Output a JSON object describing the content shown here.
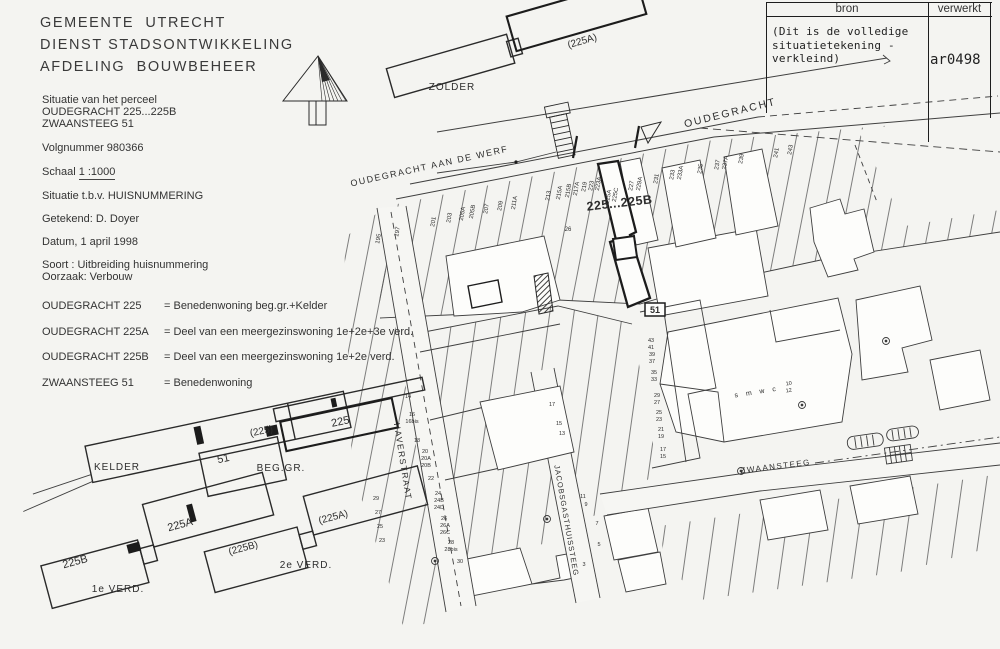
{
  "header": {
    "line1": "GEMEENTE  UTRECHT",
    "line2": "DIENST STADSONTWIKKELING",
    "line3": "AFDELING  BOUWBEHEER"
  },
  "info": {
    "situatie_label": "Situatie van het perceel",
    "address1": "OUDEGRACHT 225...225B",
    "address2": "ZWAANSTEEG 51",
    "volgnummer": "Volgnummer 980366",
    "schaal_label": "Schaal",
    "schaal_value": "1 :1000",
    "situatie_tbv": "Situatie t.b.v. HUISNUMMERING",
    "getekend": "Getekend: D. Doyer",
    "datum": "Datum, 1 april 1998",
    "soort": "Soort : Uitbreiding huisnummering",
    "oorzaak": "Oorzaak: Verbouw"
  },
  "legend": [
    {
      "address": "OUDEGRACHT 225",
      "desc": "= Benedenwoning beg.gr.+Kelder"
    },
    {
      "address": "OUDEGRACHT 225A",
      "desc": "= Deel van een meergezinswoning 1e+2e+3e verd."
    },
    {
      "address": "OUDEGRACHT 225B",
      "desc": "= Deel van een meergezinswoning 1e+2e verd."
    },
    {
      "address": "ZWAANSTEEG 51",
      "desc": "= Benedenwoning"
    }
  ],
  "stamp_table": {
    "col1": "bron",
    "col2": "verwerkt",
    "note": "(Dit is de volledige\nsituatietekening -\nverkleind)",
    "code": "ar0498"
  },
  "plans": {
    "labels": [
      {
        "t": "(225A)",
        "x": 583,
        "y": 44,
        "r": -16,
        "s": 10
      },
      {
        "t": "ZOLDER",
        "x": 452,
        "y": 90,
        "r": 0,
        "s": 10,
        "ls": 1
      },
      {
        "t": "(225)",
        "x": 262,
        "y": 434,
        "r": -12,
        "s": 10
      },
      {
        "t": "KELDER",
        "x": 117,
        "y": 470,
        "r": 0,
        "s": 10,
        "ls": 1
      },
      {
        "t": "51",
        "x": 224,
        "y": 462,
        "r": -12,
        "s": 11
      },
      {
        "t": "225",
        "x": 341,
        "y": 425,
        "r": -12,
        "s": 11
      },
      {
        "t": "BEG.GR.",
        "x": 281,
        "y": 471,
        "r": 0,
        "s": 10,
        "ls": 1
      },
      {
        "t": "225B",
        "x": 76,
        "y": 565,
        "r": -15,
        "s": 11
      },
      {
        "t": "225A",
        "x": 181,
        "y": 528,
        "r": -15,
        "s": 11
      },
      {
        "t": "1e VERD.",
        "x": 118,
        "y": 592,
        "r": 0,
        "s": 10,
        "ls": 1
      },
      {
        "t": "(225B)",
        "x": 244,
        "y": 551,
        "r": -15,
        "s": 10
      },
      {
        "t": "(225A)",
        "x": 334,
        "y": 520,
        "r": -15,
        "s": 10
      },
      {
        "t": "2e VERD.",
        "x": 306,
        "y": 568,
        "r": 0,
        "s": 10,
        "ls": 1
      }
    ]
  },
  "map": {
    "street_labels": [
      {
        "t": "OUDEGRACHT AAN DE WERF",
        "x": 430,
        "y": 169,
        "r": -12.5,
        "s": 9,
        "ls": 1.5
      },
      {
        "t": "OUDEGRACHT",
        "x": 731,
        "y": 116,
        "r": -14,
        "s": 10.5,
        "ls": 2
      },
      {
        "t": "HAVERSTRAAT",
        "x": 400,
        "y": 462,
        "r": 81,
        "s": 8.5,
        "ls": 1.5
      },
      {
        "t": "JACOBSGASTHUISSTEEG",
        "x": 564,
        "y": 521,
        "r": 80,
        "s": 7.5,
        "ls": 1
      },
      {
        "t": "ZWAANSTEEG",
        "x": 776,
        "y": 469,
        "r": -7,
        "s": 8,
        "ls": 1.5
      }
    ],
    "key_labels": [
      {
        "t": "225...225B",
        "x": 620,
        "y": 207,
        "r": -6.5,
        "s": 12.5,
        "w": 700,
        "ls": 0.5
      },
      {
        "t": "51",
        "x": 655,
        "y": 313,
        "r": 0,
        "s": 9,
        "w": 700
      },
      {
        "t": "s m w c",
        "x": 757,
        "y": 394,
        "r": -9,
        "s": 7,
        "ls": 3
      },
      {
        "t": "10",
        "x": 789,
        "y": 385,
        "r": -9,
        "s": 5.5
      },
      {
        "t": "12",
        "x": 789,
        "y": 392,
        "r": -9,
        "s": 5.5
      }
    ],
    "parcel_numbers": [
      {
        "t": "195",
        "x": 380,
        "y": 239,
        "r": -80,
        "s": 6
      },
      {
        "t": "197",
        "x": 399,
        "y": 232,
        "r": -80,
        "s": 6
      },
      {
        "t": "201",
        "x": 435,
        "y": 222,
        "r": -80,
        "s": 6
      },
      {
        "t": "203",
        "x": 451,
        "y": 218,
        "r": -80,
        "s": 6
      },
      {
        "t": "205A",
        "x": 464,
        "y": 214,
        "r": -80,
        "s": 6
      },
      {
        "t": "205B",
        "x": 474,
        "y": 212,
        "r": -80,
        "s": 6
      },
      {
        "t": "207",
        "x": 488,
        "y": 209,
        "r": -80,
        "s": 6
      },
      {
        "t": "209",
        "x": 502,
        "y": 206,
        "r": -80,
        "s": 6
      },
      {
        "t": "211A",
        "x": 516,
        "y": 203,
        "r": -80,
        "s": 6
      },
      {
        "t": "213",
        "x": 550,
        "y": 196,
        "r": -80,
        "s": 6
      },
      {
        "t": "215A",
        "x": 561,
        "y": 193,
        "r": -80,
        "s": 6
      },
      {
        "t": "215B",
        "x": 570,
        "y": 191,
        "r": -80,
        "s": 6
      },
      {
        "t": "217A",
        "x": 578,
        "y": 189,
        "r": -80,
        "s": 6
      },
      {
        "t": "219",
        "x": 586,
        "y": 187,
        "r": -80,
        "s": 6
      },
      {
        "t": "223",
        "x": 593,
        "y": 186,
        "r": -80,
        "s": 6
      },
      {
        "t": "223A",
        "x": 600,
        "y": 184,
        "r": -80,
        "s": 6
      },
      {
        "t": "225A",
        "x": 610,
        "y": 197,
        "r": -80,
        "s": 6
      },
      {
        "t": "225C",
        "x": 617,
        "y": 195,
        "r": -80,
        "s": 6
      },
      {
        "t": "227",
        "x": 633,
        "y": 186,
        "r": -80,
        "s": 6
      },
      {
        "t": "229A",
        "x": 641,
        "y": 184,
        "r": -80,
        "s": 6
      },
      {
        "t": "231",
        "x": 658,
        "y": 179,
        "r": -80,
        "s": 6
      },
      {
        "t": "233",
        "x": 674,
        "y": 175,
        "r": -80,
        "s": 6
      },
      {
        "t": "233A",
        "x": 682,
        "y": 173,
        "r": -80,
        "s": 6
      },
      {
        "t": "235",
        "x": 702,
        "y": 169,
        "r": -80,
        "s": 6
      },
      {
        "t": "237",
        "x": 719,
        "y": 165,
        "r": -80,
        "s": 6
      },
      {
        "t": "237A",
        "x": 727,
        "y": 163,
        "r": -80,
        "s": 6
      },
      {
        "t": "239",
        "x": 743,
        "y": 159,
        "r": -80,
        "s": 6
      },
      {
        "t": "241",
        "x": 778,
        "y": 153,
        "r": -80,
        "s": 6
      },
      {
        "t": "243",
        "x": 792,
        "y": 150,
        "r": -80,
        "s": 6
      },
      {
        "t": "26",
        "x": 568,
        "y": 231,
        "r": 0,
        "s": 6
      },
      {
        "t": "43",
        "x": 651,
        "y": 342,
        "r": 0,
        "s": 5.5
      },
      {
        "t": "41",
        "x": 651,
        "y": 349,
        "r": 0,
        "s": 5.5
      },
      {
        "t": "39",
        "x": 652,
        "y": 356,
        "r": 0,
        "s": 5.5
      },
      {
        "t": "37",
        "x": 652,
        "y": 363,
        "r": 0,
        "s": 5.5
      },
      {
        "t": "35",
        "x": 654,
        "y": 374,
        "r": 0,
        "s": 5.5
      },
      {
        "t": "33",
        "x": 654,
        "y": 381,
        "r": 0,
        "s": 5.5
      },
      {
        "t": "29",
        "x": 657,
        "y": 397,
        "r": 0,
        "s": 5.5
      },
      {
        "t": "27",
        "x": 657,
        "y": 404,
        "r": 0,
        "s": 5.5
      },
      {
        "t": "25",
        "x": 659,
        "y": 414,
        "r": 0,
        "s": 5.5
      },
      {
        "t": "23",
        "x": 659,
        "y": 421,
        "r": 0,
        "s": 5.5
      },
      {
        "t": "21",
        "x": 661,
        "y": 431,
        "r": 0,
        "s": 5.5
      },
      {
        "t": "19",
        "x": 661,
        "y": 438,
        "r": 0,
        "s": 5.5
      },
      {
        "t": "17",
        "x": 663,
        "y": 451,
        "r": 0,
        "s": 5.5
      },
      {
        "t": "15",
        "x": 663,
        "y": 458,
        "r": 0,
        "s": 5.5
      },
      {
        "t": "14",
        "x": 408,
        "y": 398,
        "r": 0,
        "s": 5.5
      },
      {
        "t": "16",
        "x": 412,
        "y": 416,
        "r": 0,
        "s": 5.5
      },
      {
        "t": "16bis",
        "x": 412,
        "y": 423,
        "r": 0,
        "s": 5.5
      },
      {
        "t": "18",
        "x": 417,
        "y": 442,
        "r": 0,
        "s": 5.5
      },
      {
        "t": "20",
        "x": 425,
        "y": 453,
        "r": 0,
        "s": 5.5
      },
      {
        "t": "20A",
        "x": 426,
        "y": 460,
        "r": 0,
        "s": 5.5
      },
      {
        "t": "20B",
        "x": 426,
        "y": 467,
        "r": 0,
        "s": 5.5
      },
      {
        "t": "22",
        "x": 431,
        "y": 480,
        "r": 0,
        "s": 5.5
      },
      {
        "t": "24",
        "x": 438,
        "y": 495,
        "r": 0,
        "s": 5.5
      },
      {
        "t": "24B",
        "x": 439,
        "y": 502,
        "r": 0,
        "s": 5.5
      },
      {
        "t": "24D",
        "x": 439,
        "y": 509,
        "r": 0,
        "s": 5.5
      },
      {
        "t": "26",
        "x": 444,
        "y": 520,
        "r": 0,
        "s": 5.5
      },
      {
        "t": "26A",
        "x": 445,
        "y": 527,
        "r": 0,
        "s": 5.5
      },
      {
        "t": "26C",
        "x": 445,
        "y": 534,
        "r": 0,
        "s": 5.5
      },
      {
        "t": "28",
        "x": 451,
        "y": 544,
        "r": 0,
        "s": 5.5
      },
      {
        "t": "28bis",
        "x": 451,
        "y": 551,
        "r": 0,
        "s": 5.5
      },
      {
        "t": "30",
        "x": 460,
        "y": 563,
        "r": 0,
        "s": 5.5
      },
      {
        "t": "17",
        "x": 552,
        "y": 406,
        "r": 0,
        "s": 5.5
      },
      {
        "t": "15",
        "x": 559,
        "y": 425,
        "r": 0,
        "s": 5.5
      },
      {
        "t": "13",
        "x": 562,
        "y": 435,
        "r": 0,
        "s": 5.5
      },
      {
        "t": "11",
        "x": 583,
        "y": 498,
        "r": 0,
        "s": 5.5
      },
      {
        "t": "9",
        "x": 586,
        "y": 506,
        "r": 0,
        "s": 5.5
      },
      {
        "t": "7",
        "x": 597,
        "y": 525,
        "r": 0,
        "s": 5.5
      },
      {
        "t": "5",
        "x": 599,
        "y": 546,
        "r": 0,
        "s": 5.5
      },
      {
        "t": "3",
        "x": 584,
        "y": 566,
        "r": 0,
        "s": 5.5
      },
      {
        "t": "29",
        "x": 376,
        "y": 500,
        "r": 0,
        "s": 5.5
      },
      {
        "t": "27",
        "x": 378,
        "y": 514,
        "r": 0,
        "s": 5.5
      },
      {
        "t": "25",
        "x": 380,
        "y": 528,
        "r": 0,
        "s": 5.5
      },
      {
        "t": "23",
        "x": 382,
        "y": 542,
        "r": 0,
        "s": 5.5
      }
    ]
  }
}
